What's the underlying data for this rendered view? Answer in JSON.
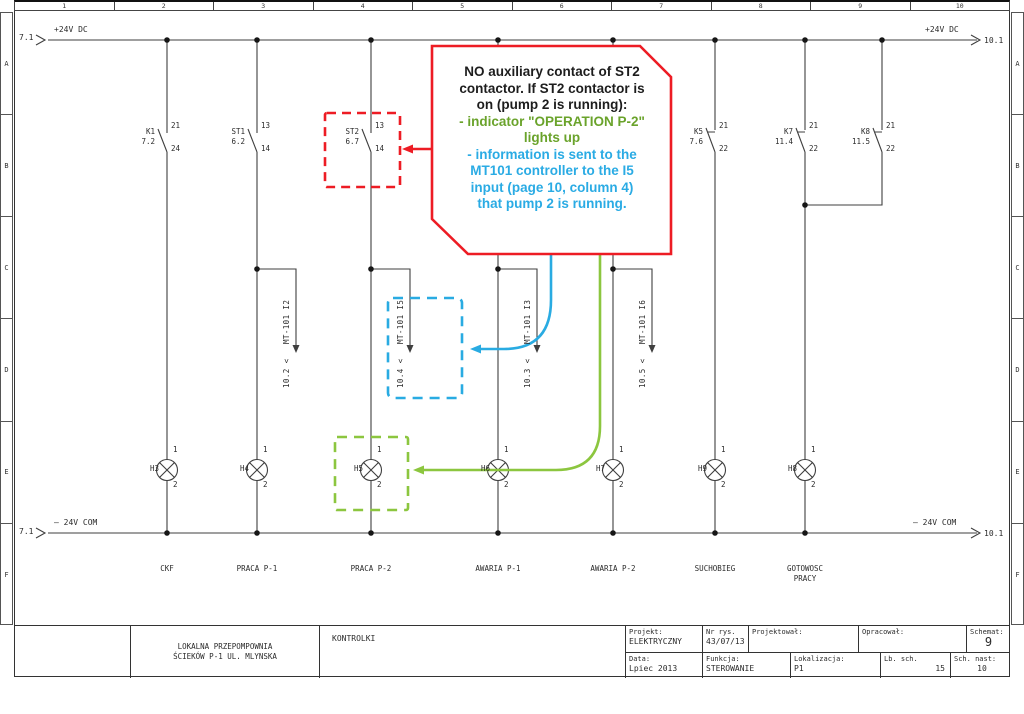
{
  "ruler": {
    "cols": [
      "1",
      "2",
      "3",
      "4",
      "5",
      "6",
      "7",
      "8",
      "9",
      "10"
    ],
    "rows": [
      "A",
      "B",
      "C",
      "D",
      "E",
      "F"
    ]
  },
  "rails": {
    "top": {
      "left_ref": "7.1",
      "label": "+24V DC",
      "right_label": "+24V DC",
      "right_ref": "10.1"
    },
    "bottom": {
      "left_ref": "7.1",
      "label": "– 24V COM",
      "right_label": "– 24V COM",
      "right_ref": "10.1"
    }
  },
  "contacts": [
    {
      "name": "K1",
      "ref": "7.2",
      "t_top": "21",
      "t_bot": "24"
    },
    {
      "name": "ST1",
      "ref": "6.2",
      "t_top": "13",
      "t_bot": "14"
    },
    {
      "name": "ST2",
      "ref": "6.7",
      "t_top": "13",
      "t_bot": "14"
    },
    {
      "name": "K5",
      "ref": "7.6",
      "t_top": "21",
      "t_bot": "22"
    },
    {
      "name": "K7",
      "ref": "11.4",
      "t_top": "21",
      "t_bot": "22"
    },
    {
      "name": "K8",
      "ref": "11.5",
      "t_top": "21",
      "t_bot": "22"
    }
  ],
  "branches": [
    {
      "label": "MT-101 I2",
      "dest": "10.2 <"
    },
    {
      "label": "MT-101 I5",
      "dest": "10.4 <"
    },
    {
      "label": "MT-101 I3",
      "dest": "10.3 <"
    },
    {
      "label": "MT-101 I6",
      "dest": "10.5 <"
    }
  ],
  "lamps": [
    {
      "name": "H3",
      "t_top": "1",
      "t_bot": "2",
      "caption": "CKF"
    },
    {
      "name": "H4",
      "t_top": "1",
      "t_bot": "2",
      "caption": "PRACA P-1"
    },
    {
      "name": "H5",
      "t_top": "1",
      "t_bot": "2",
      "caption": "PRACA P-2"
    },
    {
      "name": "H6",
      "t_top": "1",
      "t_bot": "2",
      "caption": "AWARIA P-1"
    },
    {
      "name": "H7",
      "t_top": "1",
      "t_bot": "2",
      "caption": "AWARIA P-2"
    },
    {
      "name": "H9",
      "t_top": "1",
      "t_bot": "2",
      "caption": "SUCHOBIEG"
    },
    {
      "name": "H8",
      "t_top": "1",
      "t_bot": "2",
      "caption": "GOTOWOSC\nPRACY"
    }
  ],
  "callout": {
    "lines": [
      {
        "text": "NO auxiliary contact of ST2",
        "color": "black"
      },
      {
        "text": "contactor. If ST2 contactor is",
        "color": "black"
      },
      {
        "text": "on (pump 2 is running):",
        "color": "black"
      },
      {
        "text": "- indicator \"OPERATION P-2\"",
        "color": "green"
      },
      {
        "text": "lights up",
        "color": "green"
      },
      {
        "text": "- information is sent to the",
        "color": "blue"
      },
      {
        "text": "MT101 controller to the I5",
        "color": "blue"
      },
      {
        "text": "input (page 10, column 4)",
        "color": "blue"
      },
      {
        "text": "that pump 2 is running.",
        "color": "blue"
      }
    ]
  },
  "title_block": {
    "company_line1": "LOKALNA PRZEPOMPOWNIA",
    "company_line2": "ŚCIEKÓW  P-1  UL. MLYNSKA",
    "drawing_title": "KONTROLKI",
    "projekt_label": "Projekt:",
    "projekt_value": "ELEKTRYCZNY",
    "nr_rys_label": "Nr rys.",
    "nr_rys_value": "43/07/13",
    "projektowal_label": "Projektował:",
    "opracowal_label": "Opracował:",
    "schemat_label": "Schemat:",
    "schemat_value": "9",
    "data_label": "Data:",
    "data_value": "Lpiec 2013",
    "funkcja_label": "Funkcja:",
    "funkcja_value": "STEROWANIE",
    "lokalizacja_label": "Lokalizacja:",
    "lokalizacja_value": "P1",
    "lb_sch_label": "Lb. sch.",
    "lb_sch_value": "15",
    "sch_nast_label": "Sch. nast:",
    "sch_nast_value": "10"
  },
  "colors": {
    "red": "#ed1c24",
    "green": "#8cc63f",
    "green_text": "#6aa32b",
    "blue": "#29abe2",
    "line": "#3f3f3f"
  }
}
